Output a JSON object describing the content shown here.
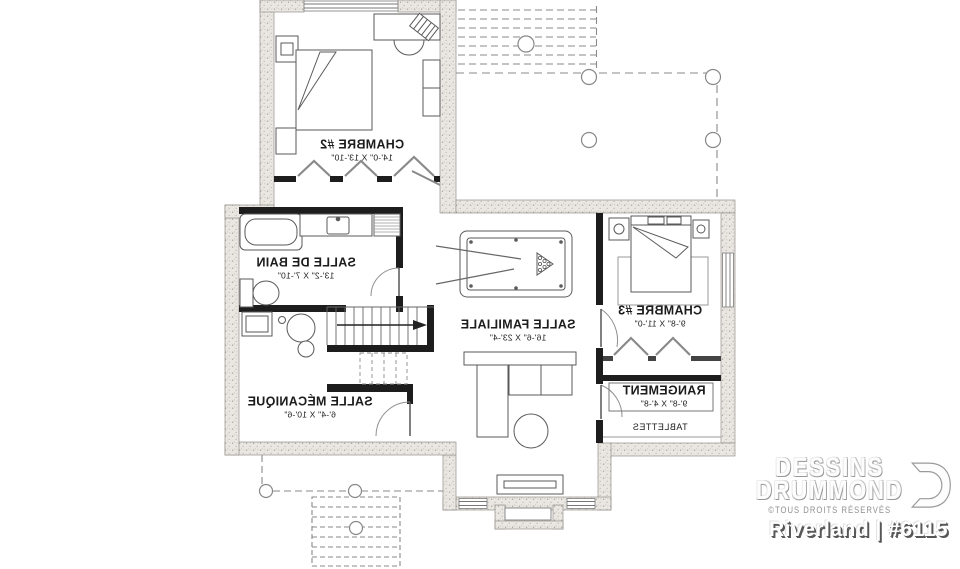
{
  "plan": {
    "rooms": [
      {
        "id": "chambre2",
        "name": "CHAMBRE #2",
        "dims": "14'-0\" X 13'-10\""
      },
      {
        "id": "salle-de-bain",
        "name": "SALLE DE BAIN",
        "dims": "13'-2\" X 7'-10\""
      },
      {
        "id": "salle-familiale",
        "name": "SALLE FAMILIALE",
        "dims": "16'-6\" X 23'-4\""
      },
      {
        "id": "chambre3",
        "name": "CHAMBRE #3",
        "dims": "9'-8\" X 11'-0\""
      },
      {
        "id": "salle-mecanique",
        "name": "SALLE MÉCANIQUE",
        "dims": "6'-4\" X 10'-6\""
      },
      {
        "id": "rangement",
        "name": "RANGEMENT",
        "dims": "9'-8\" X 4'-8\""
      }
    ],
    "annotations": {
      "tablettes": "TABLETTES"
    }
  },
  "branding": {
    "company_line1": "DESSINS",
    "company_line2": "DRUMMOND",
    "rights": "©TOUS DROITS RÉSERVÉS",
    "plan_title": "Riverland | #6115",
    "logo_icon": "drummond-d-monogram"
  },
  "colors": {
    "exterior_wall_fill": "#eae7e2",
    "exterior_wall_speckle": "#a9a49c",
    "interior_wall": "#1d1d1d",
    "linework": "#5a5a5a",
    "dashed_deck": "#8a8a8a",
    "label_text": "#1c1c1c",
    "watermark": "#ffffff",
    "watermark_shadow": "#8a8a8a"
  }
}
